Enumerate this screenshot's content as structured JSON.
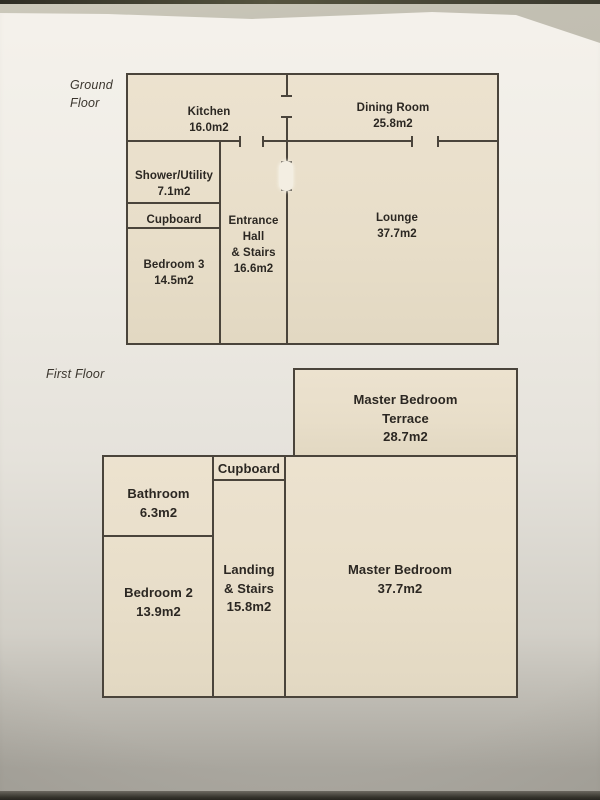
{
  "colors": {
    "paper": "#efece5",
    "room_fill": "#e9dfca",
    "wall_line": "#4a443b",
    "label_text": "#2b2722",
    "backdrop": "#b7b4a7",
    "photo_edge_dark": "#35332c"
  },
  "ground_floor": {
    "label_line1": "Ground",
    "label_line2": "Floor",
    "rooms": {
      "kitchen": {
        "name": "Kitchen",
        "area": "16.0m2"
      },
      "dining_room": {
        "name": "Dining Room",
        "area": "25.8m2"
      },
      "shower_utility": {
        "name": "Shower/Utility",
        "area": "7.1m2"
      },
      "cupboard": {
        "name": "Cupboard"
      },
      "bedroom_3": {
        "name": "Bedroom 3",
        "area": "14.5m2"
      },
      "entrance_hall": {
        "line1": "Entrance",
        "line2": "Hall",
        "line3": "& Stairs",
        "area": "16.6m2"
      },
      "lounge": {
        "name": "Lounge",
        "area": "37.7m2"
      }
    }
  },
  "first_floor": {
    "label": "First Floor",
    "rooms": {
      "master_bedroom_terrace": {
        "line1": "Master Bedroom",
        "line2": "Terrace",
        "area": "28.7m2"
      },
      "cupboard": {
        "name": "Cupboard"
      },
      "bathroom": {
        "name": "Bathroom",
        "area": "6.3m2"
      },
      "bedroom_2": {
        "name": "Bedroom 2",
        "area": "13.9m2"
      },
      "landing": {
        "line1": "Landing",
        "line2": "& Stairs",
        "area": "15.8m2"
      },
      "master_bedroom": {
        "name": "Master Bedroom",
        "area": "37.7m2"
      }
    }
  }
}
